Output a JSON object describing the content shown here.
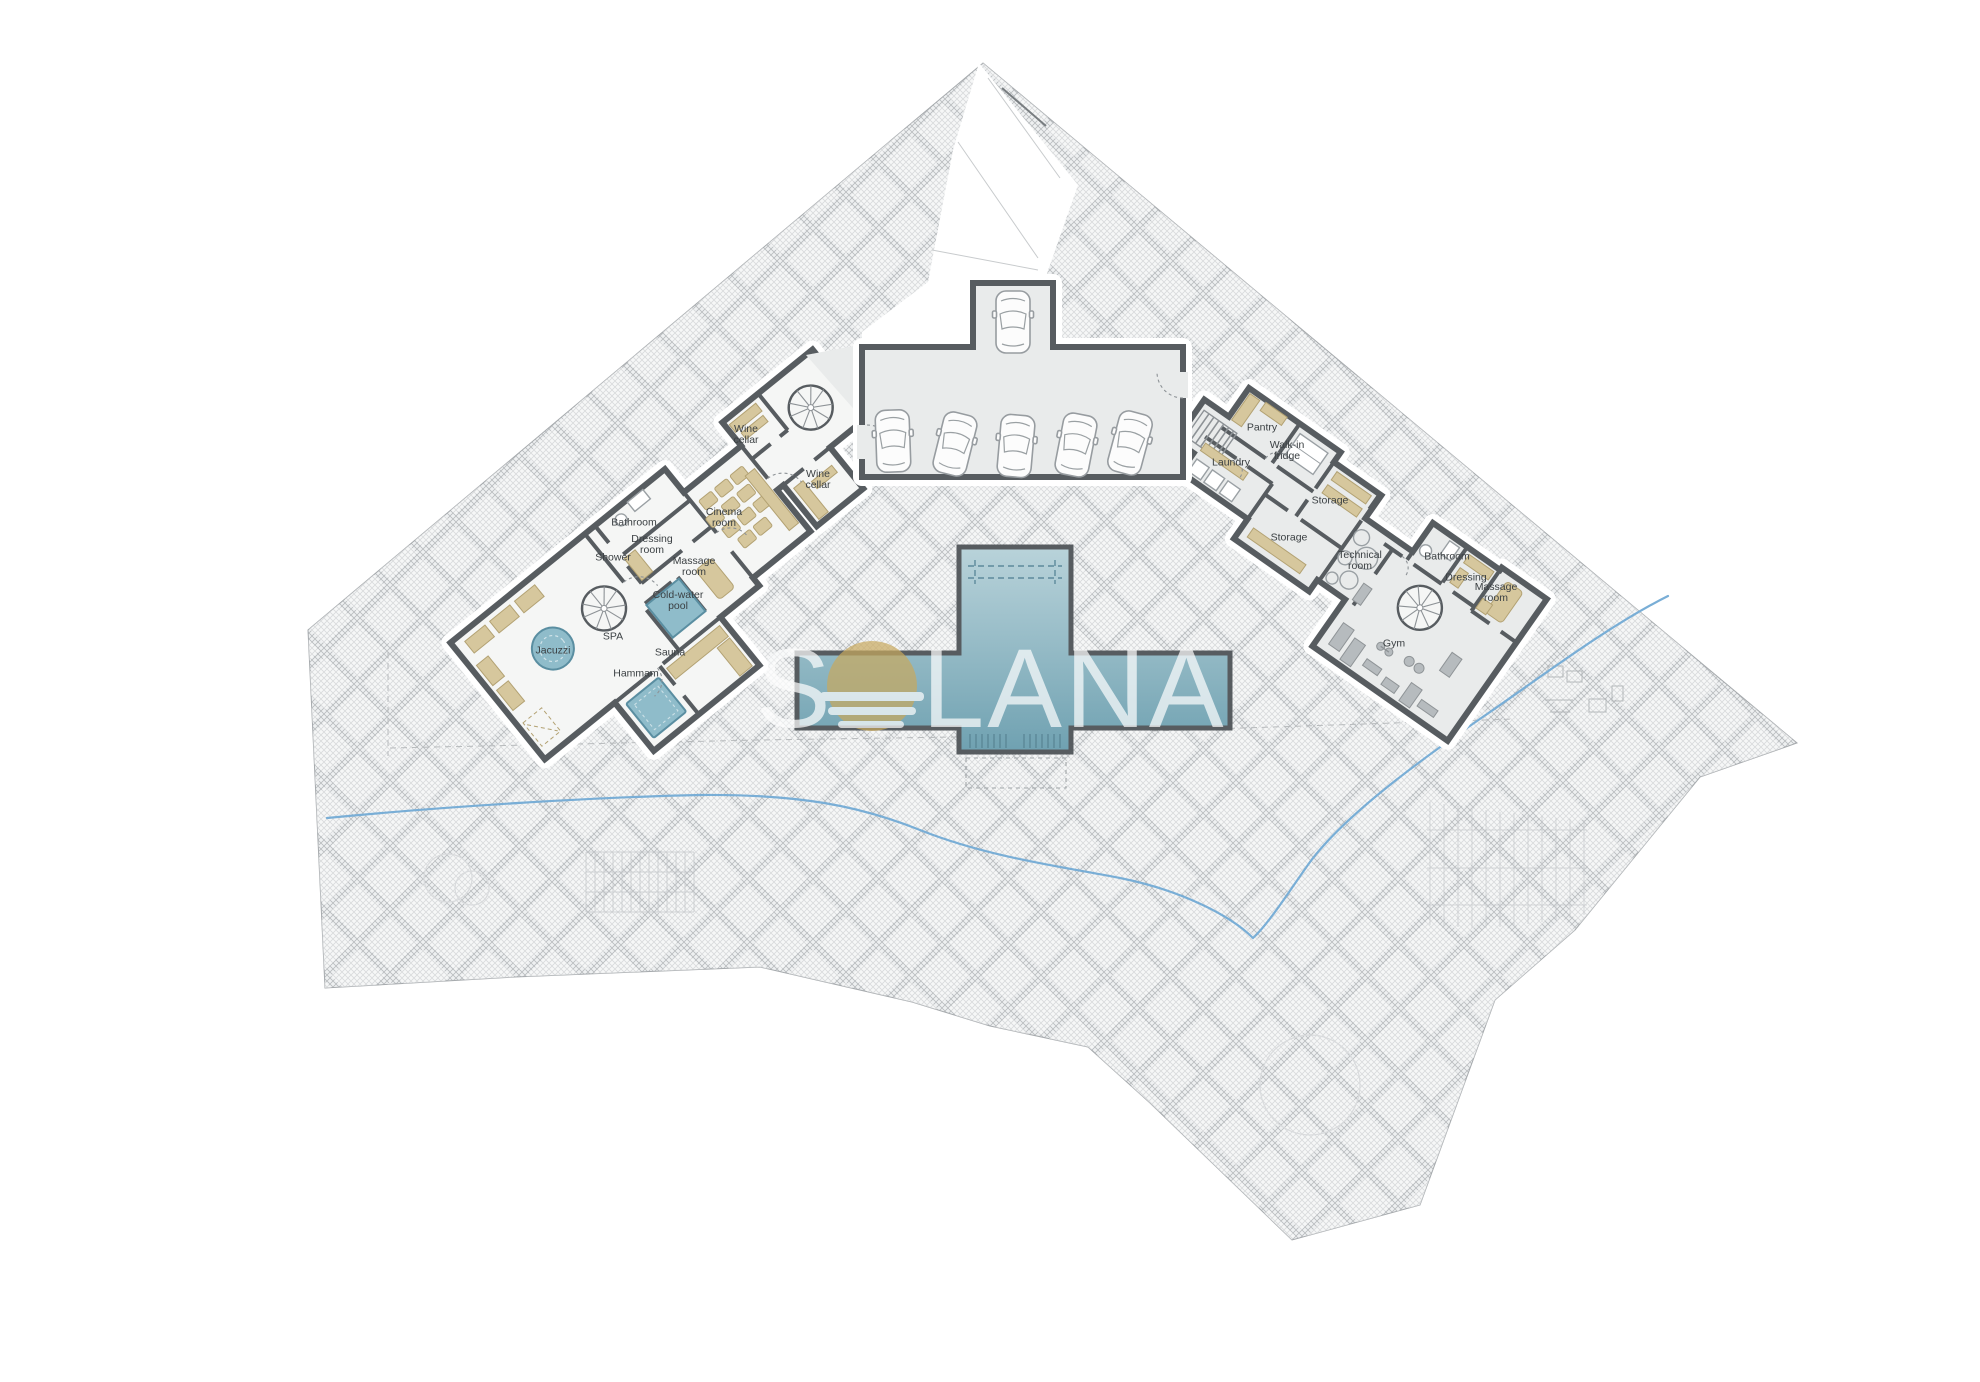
{
  "watermark": {
    "prefix": "S",
    "suffix": "LANA",
    "logo": "sun-over-water",
    "opacity": 0.7
  },
  "garage": {
    "car_count": 6
  },
  "colors": {
    "wall": "#575c60",
    "wall-light": "#8d9296",
    "floor": "#e9ebeb",
    "spa-floor": "#f5f6f5",
    "tan": "#d6c79d",
    "tan-stroke": "#b3a273",
    "water": "#8fbcca",
    "water-stroke": "#5a8ea1",
    "pool-light": "#b9d3da",
    "pool-dark": "#6fa1b1",
    "stream": "#79aed6",
    "gold": "#c8a95e",
    "label": "#3b4043",
    "faint": "#c3c6c9",
    "fixture": "#9aa0a4",
    "hatch-line": "#a6aaad",
    "site-bg": "#eef0f1"
  },
  "rooms": [
    {
      "id": "wine-cellar-a",
      "label": "Wine\ncellar",
      "x": 746,
      "y": 434
    },
    {
      "id": "wine-cellar-b",
      "label": "Wine\ncellar",
      "x": 818,
      "y": 479
    },
    {
      "id": "cinema-room",
      "label": "Cinema\nroom",
      "x": 724,
      "y": 517
    },
    {
      "id": "bathroom-left",
      "label": "Bathroom",
      "x": 634,
      "y": 522
    },
    {
      "id": "dressing-room-left",
      "label": "Dressing\nroom",
      "x": 652,
      "y": 544
    },
    {
      "id": "shower",
      "label": "Shower",
      "x": 613,
      "y": 557
    },
    {
      "id": "massage-room-left",
      "label": "Massage\nroom",
      "x": 694,
      "y": 566
    },
    {
      "id": "cold-water-pool",
      "label": "Cold-water\npool",
      "x": 678,
      "y": 600
    },
    {
      "id": "spa",
      "label": "SPA",
      "x": 613,
      "y": 636
    },
    {
      "id": "jacuzzi",
      "label": "Jacuzzi",
      "x": 553,
      "y": 650
    },
    {
      "id": "sauna",
      "label": "Sauna",
      "x": 670,
      "y": 652
    },
    {
      "id": "hammam",
      "label": "Hammam",
      "x": 636,
      "y": 673
    },
    {
      "id": "pantry",
      "label": "Pantry",
      "x": 1262,
      "y": 427
    },
    {
      "id": "walk-in-fridge",
      "label": "Walk-in\nfridge",
      "x": 1287,
      "y": 450
    },
    {
      "id": "laundry",
      "label": "Laundry",
      "x": 1231,
      "y": 462
    },
    {
      "id": "storage-a",
      "label": "Storage",
      "x": 1330,
      "y": 500
    },
    {
      "id": "storage-b",
      "label": "Storage",
      "x": 1289,
      "y": 537
    },
    {
      "id": "technical-room",
      "label": "Technical\nroom",
      "x": 1360,
      "y": 560
    },
    {
      "id": "bathroom-right",
      "label": "Bathroom",
      "x": 1447,
      "y": 556
    },
    {
      "id": "dressing-right",
      "label": "Dressing",
      "x": 1466,
      "y": 577
    },
    {
      "id": "massage-room-right",
      "label": "Massage\nroom",
      "x": 1496,
      "y": 592
    },
    {
      "id": "gym",
      "label": "Gym",
      "x": 1394,
      "y": 643
    }
  ]
}
